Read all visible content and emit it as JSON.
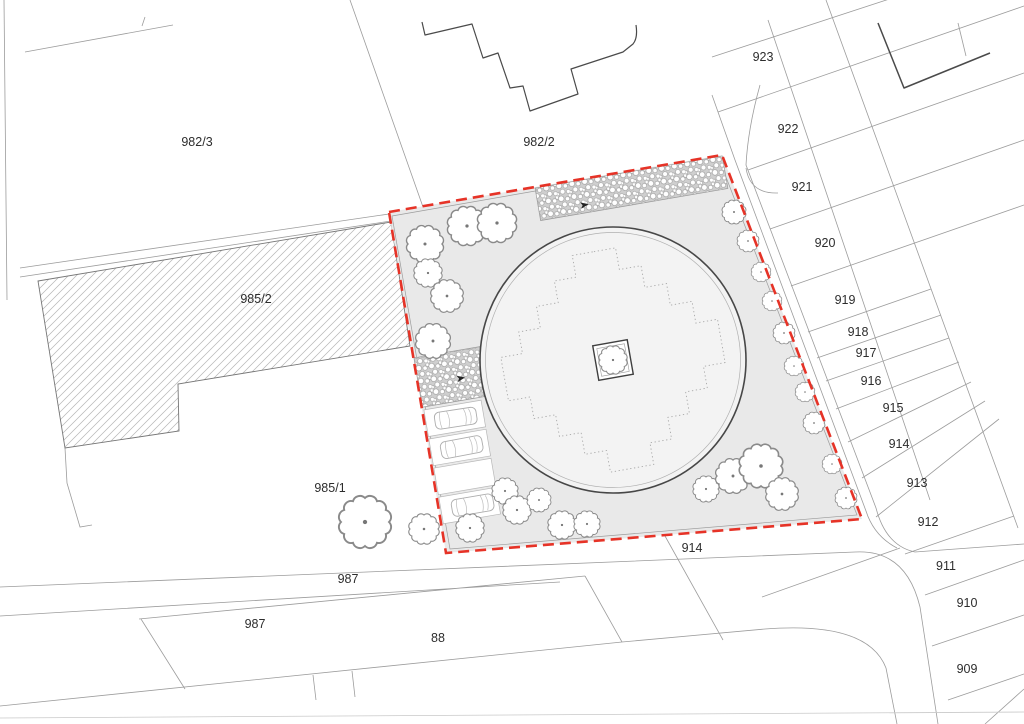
{
  "canvas": {
    "width": 1024,
    "height": 724,
    "background": "#ffffff"
  },
  "colors": {
    "boundary_red": "#e63327",
    "site_fill": "#e9e9e9",
    "plaza_fill": "#f3f3f3",
    "cadastral_line_gray": "#9c9c9c",
    "building_outline_dark": "#4a4a4a",
    "paving_gray": "#cfcfcf"
  },
  "parcels": {
    "p982_3": "982/3",
    "p982_2": "982/2",
    "p985_2": "985/2",
    "p985_1": "985/1",
    "p987_road": "987",
    "p987_parcel": "987",
    "p88": "88",
    "p914_south": "914",
    "p923": "923",
    "p922": "922",
    "p921": "921",
    "p920": "920",
    "p919": "919",
    "p918": "918",
    "p917": "917",
    "p916": "916",
    "p915": "915",
    "p914_strip": "914",
    "p913": "913",
    "p912": "912",
    "p911": "911",
    "p910": "910",
    "p909": "909"
  },
  "site": {
    "boundary_style": "red dashed",
    "parking_stall_count": 4,
    "car_count": 3,
    "tree_count": 29,
    "paving_band_count": 2,
    "glyphs": [
      "tree-icon",
      "car-icon",
      "pebble-paving",
      "direction-arrow",
      "circular-plaza",
      "central-planter"
    ]
  }
}
